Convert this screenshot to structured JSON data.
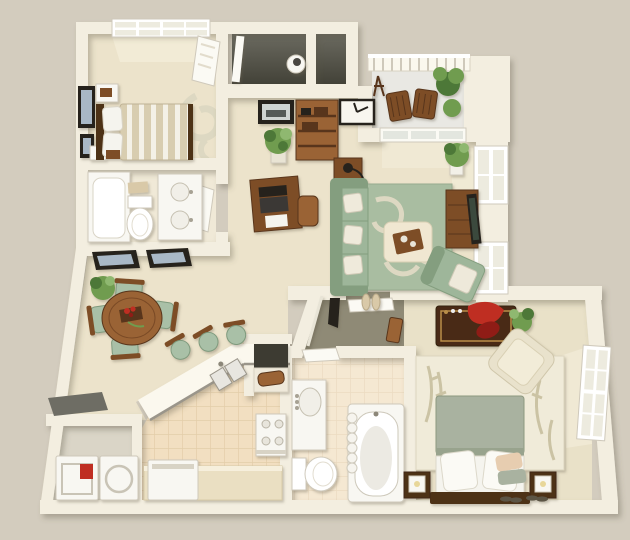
{
  "scene": {
    "kind": "3d-floorplan-render",
    "rooms": [
      "bedroom-1",
      "bathroom-1",
      "hallway",
      "living-room",
      "balcony",
      "dining-area",
      "kitchen",
      "laundry-closet",
      "walk-in-closet",
      "bathroom-2",
      "master-bedroom",
      "storage-closets"
    ],
    "furniture": {
      "bedroom-1": [
        "striped-bed",
        "headboard",
        "nightstand",
        "wall-art",
        "window",
        "swirl-decal",
        "door"
      ],
      "bathroom-1": [
        "tub-shower",
        "toilet",
        "double-sink-vanity",
        "towel"
      ],
      "hallway": [
        "bookshelf",
        "framed-photo",
        "wall-clock",
        "potted-plant",
        "desk",
        "laptop",
        "desk-chair"
      ],
      "living-room": [
        "sage-sofa",
        "throw-pillows",
        "patterned-rug",
        "ottoman-coffee-table",
        "serving-tray",
        "chaise-lounge",
        "tv-stand",
        "flat-tv",
        "side-table",
        "lamp",
        "potted-plant",
        "windows",
        "sliding-glass-door"
      ],
      "balcony": [
        "railing",
        "patio-chairs",
        "ferns",
        "easel"
      ],
      "dining-area": [
        "round-table",
        "dining-chairs",
        "centerpiece",
        "potted-plant",
        "wall-art"
      ],
      "kitchen": [
        "breakfast-bar",
        "bar-stools",
        "double-sink",
        "range-stove",
        "base-counter",
        "dishwasher",
        "pantry-shelf",
        "bread-box"
      ],
      "laundry-closet": [
        "washer",
        "dryer",
        "detergent-box",
        "entry-mat"
      ],
      "walk-in-closet": [
        "slippers",
        "storage-box",
        "hanging-clothes",
        "closet-rod"
      ],
      "bathroom-2": [
        "vanity-sink",
        "toilet",
        "bathtub",
        "shower-curtain",
        "door"
      ],
      "master-bedroom": [
        "bed",
        "sage-duvet",
        "pillows",
        "headboard",
        "nightstands",
        "cube-lamps",
        "storage-trunk",
        "red-throw",
        "armchair",
        "bamboo-rug",
        "potted-plant",
        "window",
        "slippers"
      ]
    }
  },
  "palette": {
    "bg": "#d3ccbe",
    "wall": "#f3eee0",
    "wall_edge": "#d8d1bc",
    "wall_bright": "#fbf8ee",
    "carpet": "#ece3cb",
    "carpet_master": "#e9e1c8",
    "bath1_floor": "#f0e9d7",
    "tile": "#f2dfc1",
    "tile_grout": "#e3cda9",
    "laundry_floor": "#dad5c7",
    "vestibule_floor": "#8f8a76",
    "closet_dark1": "#6b6a60",
    "closet_dark2": "#434238",
    "balcony_floor": "#e9e8e3",
    "fixture_white": "#f8f7f2",
    "fixture_stroke": "#cfc9bb",
    "door_white": "#fbfaf4",
    "window_pane": "#edebdf",
    "glass": "#e3e6df",
    "sofa": "#9eb69a",
    "sofa_dark": "#849e7f",
    "rug": "#a9bda1",
    "swirl": "#ddd8c2",
    "ottoman": "#f0e7d1",
    "wood": "#7d4e28",
    "wood_dark": "#59351a",
    "wood_light": "#9a6434",
    "trunk": "#4a2a14",
    "gold": "#b98e4a",
    "headboard": "#4e3018",
    "blanket": "#a9b2a0",
    "sheet": "#f5f4ee",
    "pillow_peach": "#e7cdb0",
    "chair_sage": "#a9c0a7",
    "chair_sage_dark": "#7f9a7d",
    "red": "#bf2f23",
    "red_dark": "#8f1f17",
    "plant": "#6f9c4f",
    "plant_dark": "#4d7837",
    "black": "#27241f",
    "tv_screen": "#3a4a3c",
    "mat_gray": "#6e6d64",
    "towel": "#d9c9a8",
    "art_blue": "#a9b8c6",
    "art_dark": "#4a4f55",
    "duvet_base": "#d8cdb0",
    "duvet_stripe": "#f4f1e7",
    "light": "#f7f2e0"
  }
}
